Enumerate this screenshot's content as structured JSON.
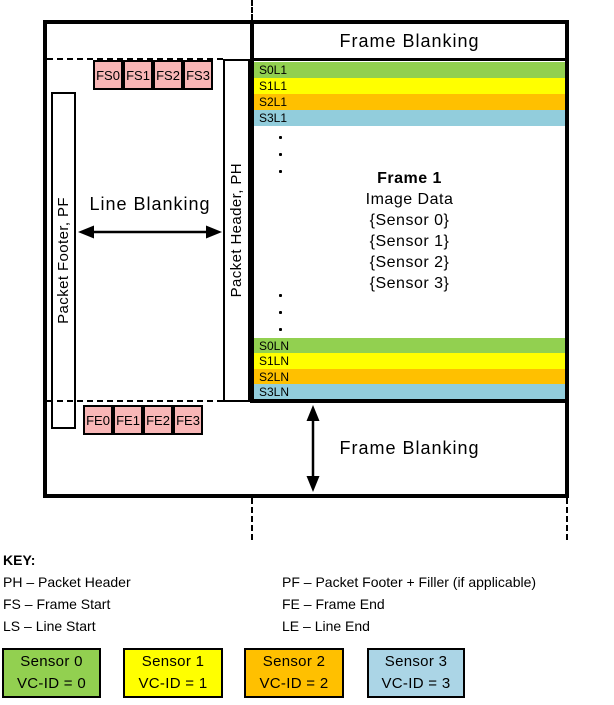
{
  "diagram": {
    "top_frame_blanking": "Frame Blanking",
    "bottom_frame_blanking": "Frame Blanking",
    "line_blanking": "Line Blanking",
    "packet_footer": "Packet Footer, PF",
    "packet_header": "Packet Header, PH",
    "frame_start_boxes": [
      "FS0",
      "FS1",
      "FS2",
      "FS3"
    ],
    "frame_end_boxes": [
      "FE0",
      "FE1",
      "FE2",
      "FE3"
    ],
    "first_line_labels": [
      {
        "label": "S0L1",
        "color": "#92D050"
      },
      {
        "label": "S1L1",
        "color": "#FFFF00"
      },
      {
        "label": "S2L1",
        "color": "#FFC000"
      },
      {
        "label": "S3L1",
        "color": "#92CDDC"
      }
    ],
    "last_line_labels": [
      {
        "label": "S0LN",
        "color": "#92D050"
      },
      {
        "label": "S1LN",
        "color": "#FFFF00"
      },
      {
        "label": "S2LN",
        "color": "#FFC000"
      },
      {
        "label": "S3LN",
        "color": "#92CDDC"
      }
    ],
    "frame_center": {
      "title": "Frame 1",
      "lines": [
        "Image Data",
        "{Sensor 0}",
        "{Sensor 1}",
        "{Sensor 2}",
        "{Sensor 3}"
      ]
    }
  },
  "key": {
    "title": "KEY:",
    "left_entries": [
      "PH – Packet Header",
      "FS – Frame Start",
      "LS – Line Start"
    ],
    "right_entries": [
      "PF – Packet Footer + Filler (if applicable)",
      "FE – Frame End",
      "LE – Line End"
    ]
  },
  "legend": [
    {
      "sensor": "Sensor 0",
      "vc_id": "VC-ID = 0",
      "color": "#92D050"
    },
    {
      "sensor": "Sensor 1",
      "vc_id": "VC-ID = 1",
      "color": "#FFFF00"
    },
    {
      "sensor": "Sensor 2",
      "vc_id": "VC-ID = 2",
      "color": "#FFC000"
    },
    {
      "sensor": "Sensor 3",
      "vc_id": "VC-ID = 3",
      "color": "#ABD5E6"
    }
  ],
  "colors": {
    "pink": "#F8B6B6",
    "border": "#000000"
  }
}
